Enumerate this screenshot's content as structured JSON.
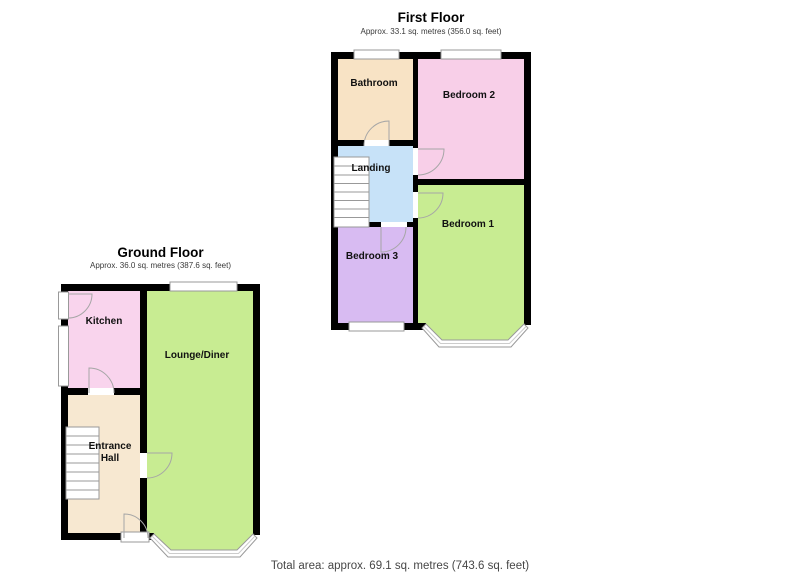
{
  "first_floor": {
    "title": "First Floor",
    "subtitle": "Approx. 33.1 sq. metres (356.0 sq. feet)",
    "rooms": {
      "bathroom": {
        "label": "Bathroom",
        "color": "#f8e3c5"
      },
      "bedroom2": {
        "label": "Bedroom 2",
        "color": "#f8cfe8"
      },
      "landing": {
        "label": "Landing",
        "color": "#c7e2f8"
      },
      "bedroom3": {
        "label": "Bedroom 3",
        "color": "#d8bbf2"
      },
      "bedroom1": {
        "label": "Bedroom 1",
        "color": "#c8ec92"
      }
    }
  },
  "ground_floor": {
    "title": "Ground Floor",
    "subtitle": "Approx. 36.0 sq. metres (387.6 sq. feet)",
    "rooms": {
      "kitchen": {
        "label": "Kitchen",
        "color": "#f9d4ed"
      },
      "lounge_diner": {
        "label": "Lounge/Diner",
        "color": "#c8ec92"
      },
      "entrance_hall": {
        "label": "Entrance Hall",
        "color": "#f7e8d1"
      }
    }
  },
  "footer": {
    "total_area": "Total area: approx. 69.1 sq. metres (743.6 sq. feet)"
  },
  "colors": {
    "wall": "#000000",
    "window_fill": "#ffffff",
    "window_frame": "#999999",
    "window_mid": "#cccccc",
    "door": "#a6a6a6",
    "door_gap": "#ffffff",
    "stairs_line": "#999999"
  }
}
